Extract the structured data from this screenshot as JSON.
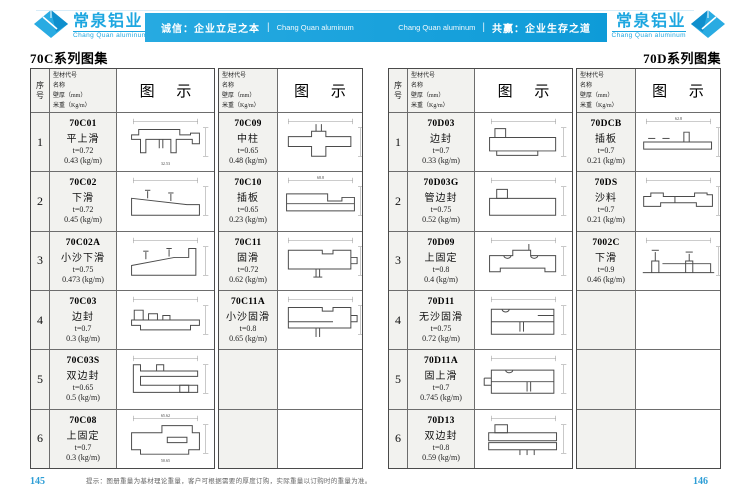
{
  "colors": {
    "accent": "#1ea7e0",
    "banner_start": "#27aae1",
    "banner_end": "#0e9bd8",
    "page_number": "#2e9ed6"
  },
  "icons": {
    "brand": "diamond-gem-icon"
  },
  "brand": {
    "name": "常泉铝业",
    "subtitle": "Chang Quan aluminum"
  },
  "banner": {
    "left_cn": "诚信：企业立足之本",
    "left_en": "Chang Quan aluminum",
    "right_en": "Chang Quan aluminum",
    "right_cn": "共赢：企业生存之道",
    "divider": "|"
  },
  "table_header": {
    "index": "序号",
    "info_lines": [
      "型材代号",
      "名称",
      "壁厚（mm）",
      "米重（Kg/m）"
    ],
    "drawing": "图 示"
  },
  "pages": [
    {
      "title": "70C系列图集",
      "page_number": "145",
      "tables": [
        {
          "has_index": true,
          "rows": [
            {
              "index": "1",
              "code": "70C01",
              "name": "平上滑",
              "thickness": "t=0.72",
              "weight": "0.43 (kg/m)",
              "shape": "hatTop",
              "dims": [
                "",
                "32.53"
              ]
            },
            {
              "index": "2",
              "code": "70C02",
              "name": "下滑",
              "thickness": "t=0.72",
              "weight": "0.45 (kg/m)",
              "shape": "slantDown",
              "dims": []
            },
            {
              "index": "3",
              "code": "70C02A",
              "name": "小沙下滑",
              "thickness": "t=0.75",
              "weight": "0.473 (kg/m)",
              "shape": "slantUp",
              "dims": []
            },
            {
              "index": "4",
              "code": "70C03",
              "name": "边封",
              "thickness": "t=0.7",
              "weight": "0.3 (kg/m)",
              "shape": "edgeBoxes",
              "dims": []
            },
            {
              "index": "5",
              "code": "70C03S",
              "name": "双边封",
              "thickness": "t=0.65",
              "weight": "0.5 (kg/m)",
              "shape": "doubleSeal",
              "dims": []
            },
            {
              "index": "6",
              "code": "70C08",
              "name": "上固定",
              "thickness": "t=0.7",
              "weight": "0.3 (kg/m)",
              "shape": "topFixed",
              "dims": [
                "65.62",
                "50.65"
              ]
            }
          ]
        },
        {
          "has_index": false,
          "rows": [
            {
              "code": "70C09",
              "name": "中柱",
              "thickness": "t=0.65",
              "weight": "0.48 (kg/m)",
              "shape": "centerCol",
              "dims": []
            },
            {
              "code": "70C10",
              "name": "插板",
              "thickness": "t=0.65",
              "weight": "0.23 (kg/m)",
              "shape": "board",
              "dims": [
                "68.8"
              ]
            },
            {
              "code": "70C11",
              "name": "固滑",
              "thickness": "t=0.72",
              "weight": "0.62 (kg/m)",
              "shape": "fixedSlide",
              "dims": []
            },
            {
              "code": "70C11A",
              "name": "小沙固滑",
              "thickness": "t=0.8",
              "weight": "0.65 (kg/m)",
              "shape": "fixedSlideSand",
              "dims": []
            },
            {
              "code": null
            },
            {
              "code": null
            }
          ]
        }
      ]
    },
    {
      "title": "70D系列图集",
      "page_number": "146",
      "tables": [
        {
          "has_index": true,
          "rows": [
            {
              "index": "1",
              "code": "70D03",
              "name": "边封",
              "thickness": "t=0.7",
              "weight": "0.33 (kg/m)",
              "shape": "sealBox",
              "dims": []
            },
            {
              "index": "2",
              "code": "70D03G",
              "name": "管边封",
              "thickness": "t=0.75",
              "weight": "0.52 (kg/m)",
              "shape": "sealBoxTall",
              "dims": []
            },
            {
              "index": "3",
              "code": "70D09",
              "name": "上固定",
              "thickness": "t=0.8",
              "weight": "0.4 (kg/m)",
              "shape": "hatSlots",
              "dims": []
            },
            {
              "index": "4",
              "code": "70D11",
              "name": "无沙固滑",
              "thickness": "t=0.75",
              "weight": "0.72 (kg/m)",
              "shape": "slideSlots",
              "dims": []
            },
            {
              "index": "5",
              "code": "70D11A",
              "name": "固上滑",
              "thickness": "t=0.7",
              "weight": "0.745 (kg/m)",
              "shape": "slideHook",
              "dims": []
            },
            {
              "index": "6",
              "code": "70D13",
              "name": "双边封",
              "thickness": "t=0.8",
              "weight": "0.59 (kg/m)",
              "shape": "wideSeal",
              "dims": []
            }
          ]
        },
        {
          "has_index": false,
          "rows": [
            {
              "code": "70DCB",
              "name": "插板",
              "thickness": "t=0.7",
              "weight": "0.21 (kg/m)",
              "shape": "barTab",
              "dims": [
                "62.8"
              ]
            },
            {
              "code": "70DS",
              "name": "沙料",
              "thickness": "t=0.7",
              "weight": "0.21 (kg/m)",
              "shape": "sandBar",
              "dims": []
            },
            {
              "code": "7002C",
              "name": "下滑",
              "thickness": "t=0.9",
              "weight": "0.46 (kg/m)",
              "shape": "twinChannel",
              "dims": []
            },
            {
              "code": null
            },
            {
              "code": null
            },
            {
              "code": null
            }
          ]
        }
      ]
    }
  ],
  "footer": {
    "note": "提示：图册重量为基材理论重量，客户可根据需要的厚度订购，实际重量以订购时的重量为准。"
  }
}
